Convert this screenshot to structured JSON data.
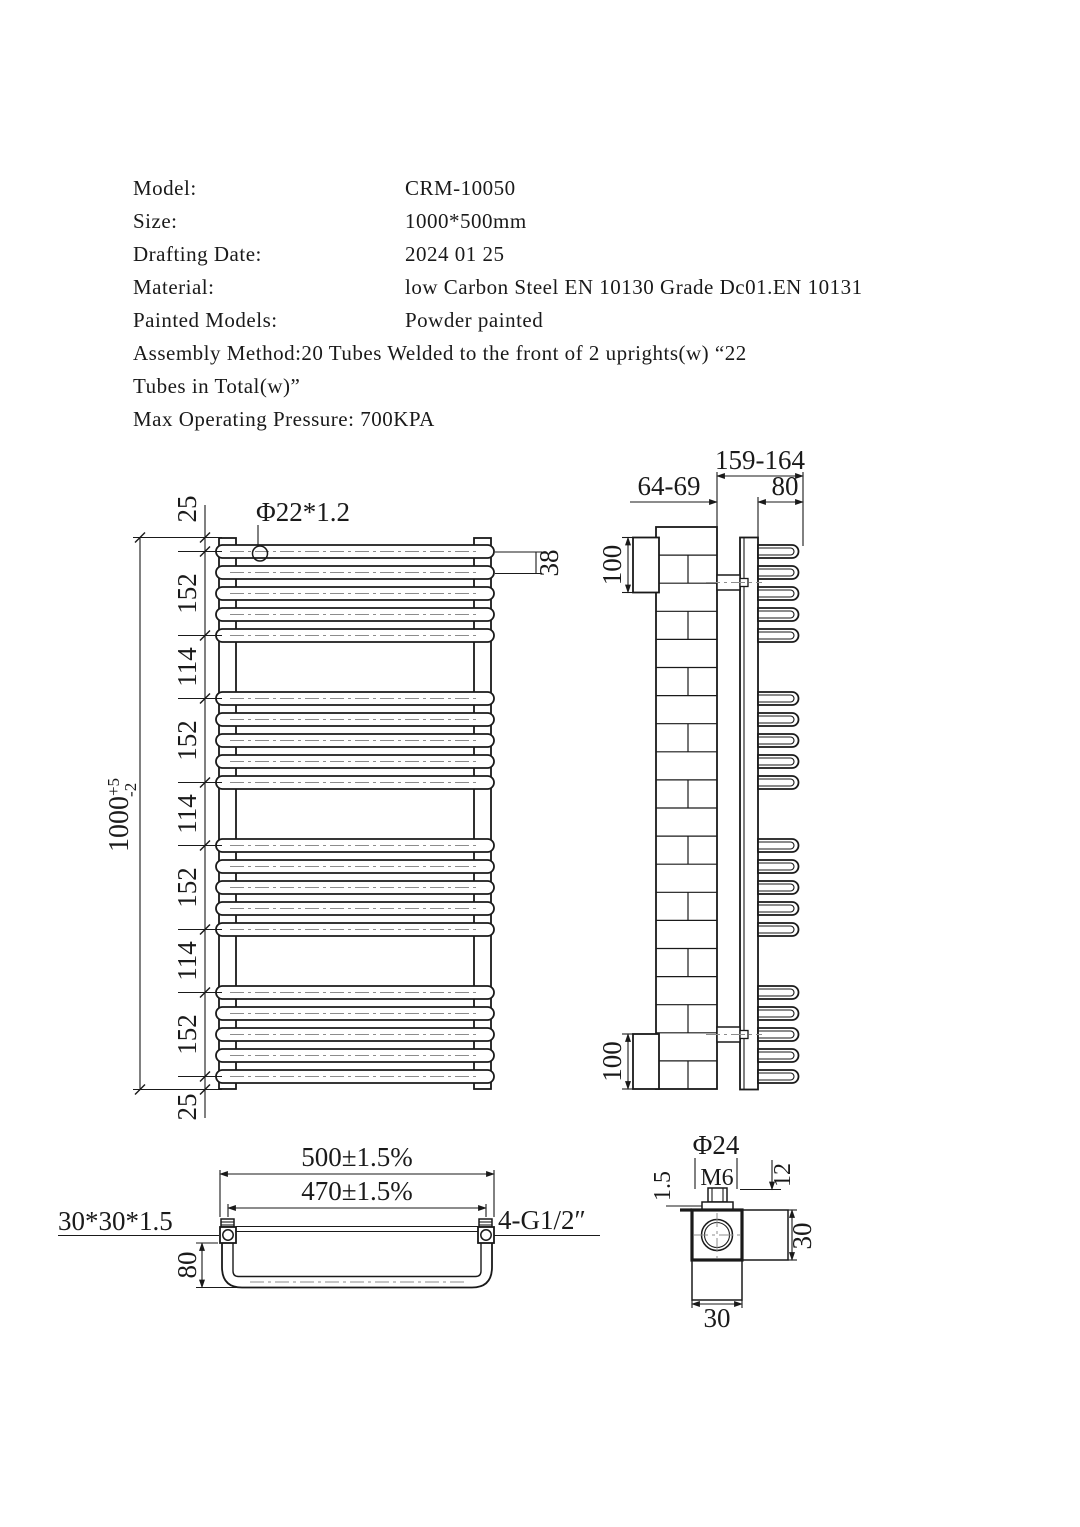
{
  "header": {
    "rows": [
      {
        "label": "Model:",
        "value": "CRM-10050"
      },
      {
        "label": "Size:",
        "value": "1000*500mm"
      },
      {
        "label": "Drafting Date:",
        "value": "2024 01 25"
      },
      {
        "label": "Material:",
        "value": "low Carbon Steel EN 10130 Grade Dc01.EN 10131"
      },
      {
        "label": "Painted Models:",
        "value": "Powder painted"
      }
    ],
    "assembly_line1": "Assembly Method:20 Tubes Welded to the front of 2 uprights(w) “22",
    "assembly_line2": "Tubes in Total(w)”",
    "max_pressure": "Max Operating Pressure: 700KPA"
  },
  "front_view": {
    "tube_spec": "Φ22*1.2",
    "segments": [
      "25",
      "152",
      "114",
      "152",
      "114",
      "152",
      "114",
      "152",
      "25"
    ],
    "overall": {
      "main": "1000",
      "plus": "+5",
      "minus": "-2"
    },
    "pitch": "38",
    "tube_count": 20,
    "tubes_per_group": 5,
    "group_count": 4
  },
  "side_view": {
    "depth_total": "159-164",
    "wall_offset": "64-69",
    "bow_depth": "80",
    "bracket_top": "100",
    "bracket_bottom": "100"
  },
  "plan_view": {
    "overall_width": "500±1.5%",
    "centers_width": "470±1.5%",
    "bow_depth": "80",
    "upright_profile": "30*30*1.5",
    "connections": "4-G1/2″"
  },
  "detail_view": {
    "cap_dia": "Φ24",
    "thread": "M6",
    "wall": "1.5",
    "stud_len": "12",
    "body_w": "30",
    "body_h": "30"
  },
  "colors": {
    "line": "#1a1a1a",
    "centerline": "#8c8c8c",
    "bg": "#ffffff"
  }
}
